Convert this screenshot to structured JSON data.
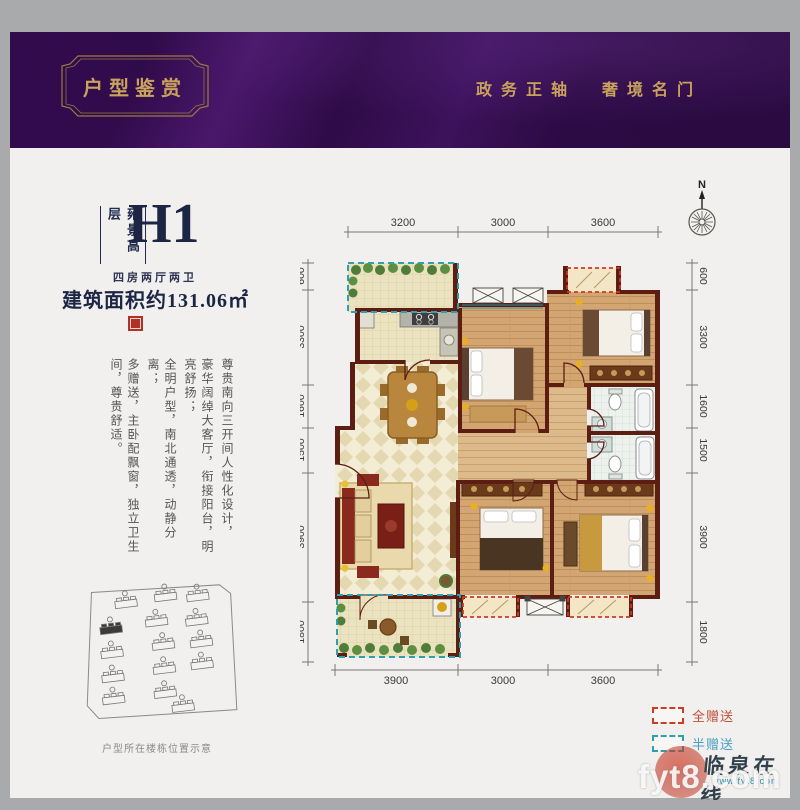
{
  "banner": {
    "title": "户型鉴赏",
    "slogan_left": "政务正轴",
    "slogan_right": "奢境名门"
  },
  "unit": {
    "series": "雍景高层",
    "code": "H1",
    "layout": "四房两厅两卫",
    "area_label": "建筑面积约131.06㎡"
  },
  "description": {
    "cols": [
      "尊贵南向三开间人性化设计，",
      "豪华阔绰大客厅，衔接阳台，明亮舒扬；",
      "全明户型，南北通透，动静分离；",
      "多赠送，主卧配飘窗，独立卫生间，尊贵舒适。"
    ]
  },
  "compass": {
    "north_label": "N"
  },
  "dimensions": {
    "top": [
      "3200",
      "3000",
      "3600"
    ],
    "bottom": [
      "3900",
      "3000",
      "3600"
    ],
    "left": [
      "600",
      "3300",
      "1600",
      "1500",
      "3900",
      "1800"
    ],
    "right": [
      "600",
      "3300",
      "1600",
      "1500",
      "3900",
      "1800"
    ]
  },
  "legend": {
    "full_label": "全赠送",
    "half_label": "半赠送",
    "full_color": "#cf3a22",
    "half_color": "#2e9fae"
  },
  "siteplan": {
    "caption": "户型所在楼栋位置示意"
  },
  "watermark": {
    "site_name": "临泉在线",
    "url": "www.fyt8.com",
    "overlay": "fyt8.com"
  },
  "colors": {
    "banner_bg": "#2a0a3e",
    "gold": "#c9a35c",
    "navy": "#1c2644",
    "wall": "#5c1d13",
    "sheet": "#f1f0ee"
  }
}
